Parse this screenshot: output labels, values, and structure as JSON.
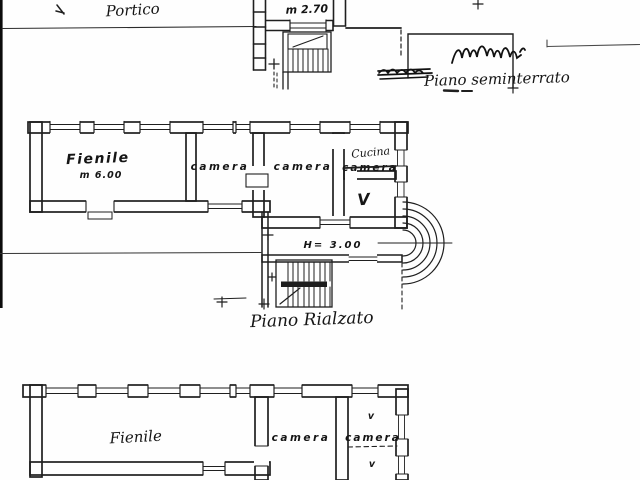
{
  "document": {
    "kind": "scanned architectural floor plan",
    "paper_color": "#fefefe",
    "ink_color": "#1f1f1f"
  },
  "floors": {
    "seminterrato": {
      "portico": "Portico",
      "stair_height": "m 2.70",
      "title": "Piano seminterrato"
    },
    "rialzato": {
      "title": "Piano Rialzato",
      "fienile": "Fienile",
      "fienile_height": "m 6.00",
      "camera1": "camera",
      "camera2": "camera",
      "cucina": "Cucina",
      "camera3": "camera",
      "vano": "V",
      "hall_height": "H= 3.00"
    },
    "upper": {
      "fienile": "Fienile",
      "camera1": "camera",
      "camera2": "camera",
      "vent_top": "v",
      "vent_bottom": "v"
    }
  }
}
